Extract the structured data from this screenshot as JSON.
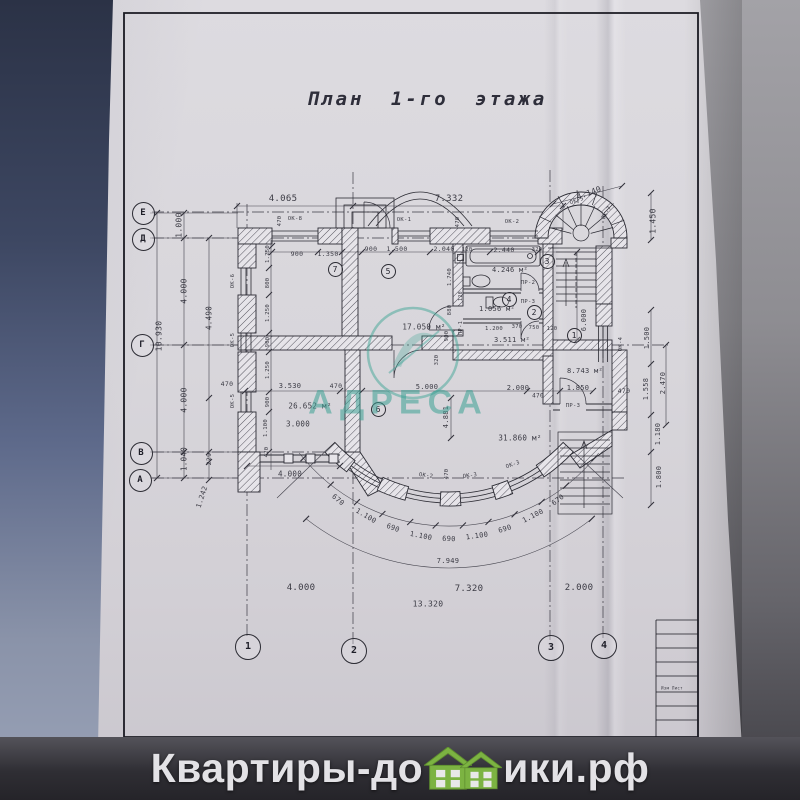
{
  "title": "План 1-го этажа",
  "watermark": {
    "logo_text": "АДРЕСА"
  },
  "brand": {
    "prefix": "Квартиры-до",
    "suffix": "ики.рф"
  },
  "colors": {
    "accent_teal": "#3fa593",
    "brand_green": "#7cb342",
    "paper": "#d8d6db",
    "ink": "#2b2b33"
  },
  "axes": {
    "left": [
      "Е",
      "Д",
      "Г",
      "В",
      "А"
    ],
    "bottom": [
      "1",
      "2",
      "3",
      "4"
    ]
  },
  "plan": {
    "axis_marks": [
      {
        "l": "Е",
        "x": 142,
        "y": 212,
        "d": 21
      },
      {
        "l": "Д",
        "x": 142,
        "y": 238,
        "d": 21
      },
      {
        "l": "Г",
        "x": 141,
        "y": 344,
        "d": 21
      },
      {
        "l": "В",
        "x": 140,
        "y": 452,
        "d": 21
      },
      {
        "l": "А",
        "x": 139,
        "y": 479,
        "d": 21
      },
      {
        "l": "1",
        "x": 247,
        "y": 646,
        "d": 24
      },
      {
        "l": "2",
        "x": 353,
        "y": 650,
        "d": 24
      },
      {
        "l": "3",
        "x": 550,
        "y": 647,
        "d": 24
      },
      {
        "l": "4",
        "x": 603,
        "y": 645,
        "d": 24
      }
    ],
    "rooms": [
      {
        "n": "7",
        "x": 334,
        "y": 268
      },
      {
        "n": "5",
        "x": 387,
        "y": 270
      },
      {
        "n": "3",
        "x": 546,
        "y": 260
      },
      {
        "n": "4",
        "x": 508,
        "y": 298
      },
      {
        "n": "2",
        "x": 533,
        "y": 311
      },
      {
        "n": "1",
        "x": 573,
        "y": 334
      },
      {
        "n": "6",
        "x": 377,
        "y": 408
      }
    ],
    "texts": [
      {
        "t": "4.065",
        "x": 283,
        "y": 199,
        "s": 9
      },
      {
        "t": "7.332",
        "x": 449,
        "y": 199,
        "s": 9
      },
      {
        "t": "4.140",
        "x": 589,
        "y": 193,
        "r": -20,
        "s": 8
      },
      {
        "t": "ОК-5",
        "x": 577,
        "y": 201,
        "r": -20,
        "s": 5.5,
        "n": "window-tag"
      },
      {
        "t": "ОК-7",
        "x": 607,
        "y": 213,
        "r": -60,
        "s": 5.5,
        "n": "window-tag"
      },
      {
        "t": "1.450",
        "x": 653,
        "y": 221,
        "r": -90,
        "s": 8
      },
      {
        "t": "ОК-8",
        "x": 295,
        "y": 219,
        "s": 5.5,
        "n": "window-tag"
      },
      {
        "t": "ОК-1",
        "x": 404,
        "y": 220,
        "s": 5.5,
        "n": "window-tag"
      },
      {
        "t": "ОК-2",
        "x": 512,
        "y": 222,
        "s": 5.5,
        "n": "window-tag"
      },
      {
        "t": "470",
        "x": 280,
        "y": 221,
        "r": -90,
        "s": 5.5
      },
      {
        "t": "470",
        "x": 458,
        "y": 222,
        "r": -90,
        "s": 5.5
      },
      {
        "t": "900",
        "x": 297,
        "y": 254,
        "s": 6.5
      },
      {
        "t": "1.350",
        "x": 328,
        "y": 254,
        "s": 6.5
      },
      {
        "t": "900",
        "x": 371,
        "y": 249,
        "s": 6.5
      },
      {
        "t": "1.500",
        "x": 397,
        "y": 249,
        "s": 6.5
      },
      {
        "t": "2.040",
        "x": 444,
        "y": 249,
        "s": 6.5
      },
      {
        "t": "120",
        "x": 467,
        "y": 250,
        "s": 5.5
      },
      {
        "t": "2.440",
        "x": 504,
        "y": 250,
        "s": 6.5
      },
      {
        "t": "320",
        "x": 537,
        "y": 250,
        "s": 5.5
      },
      {
        "t": "1.000",
        "x": 179,
        "y": 225,
        "r": -90,
        "s": 8
      },
      {
        "t": "4.000",
        "x": 184,
        "y": 291,
        "r": -90,
        "s": 8
      },
      {
        "t": "10.930",
        "x": 159,
        "y": 336,
        "r": -90,
        "s": 8
      },
      {
        "t": "4.490",
        "x": 209,
        "y": 318,
        "r": -90,
        "s": 7.5
      },
      {
        "t": "4.000",
        "x": 184,
        "y": 400,
        "r": -90,
        "s": 8
      },
      {
        "t": "1.040",
        "x": 184,
        "y": 459,
        "r": -90,
        "s": 7.5
      },
      {
        "t": "229",
        "x": 209,
        "y": 459,
        "r": -90,
        "s": 6.5
      },
      {
        "t": "1.242",
        "x": 202,
        "y": 497,
        "r": -72,
        "s": 7
      },
      {
        "t": "470",
        "x": 227,
        "y": 384,
        "s": 6.5
      },
      {
        "t": "ОК-6",
        "x": 233,
        "y": 281,
        "r": -90,
        "s": 5.5,
        "n": "window-tag"
      },
      {
        "t": "ОК-5",
        "x": 233,
        "y": 340,
        "r": -90,
        "s": 5.5,
        "n": "window-tag"
      },
      {
        "t": "ОК-5",
        "x": 233,
        "y": 401,
        "r": -90,
        "s": 5.5,
        "n": "window-tag"
      },
      {
        "t": "1.250",
        "x": 268,
        "y": 254,
        "r": -90,
        "s": 5.5
      },
      {
        "t": "800",
        "x": 268,
        "y": 283,
        "r": -90,
        "s": 5.5
      },
      {
        "t": "1.250",
        "x": 268,
        "y": 313,
        "r": -90,
        "s": 5.5
      },
      {
        "t": "900",
        "x": 268,
        "y": 342,
        "r": -90,
        "s": 5.5
      },
      {
        "t": "1.250",
        "x": 268,
        "y": 370,
        "r": -90,
        "s": 5.5
      },
      {
        "t": "900",
        "x": 268,
        "y": 402,
        "r": -90,
        "s": 5.5
      },
      {
        "t": "1.100",
        "x": 266,
        "y": 428,
        "r": -90,
        "s": 5.5
      },
      {
        "t": "470",
        "x": 267,
        "y": 452,
        "r": -90,
        "s": 5.5
      },
      {
        "t": "17.050 м²",
        "x": 424,
        "y": 327,
        "s": 7.5,
        "n": "room-area-label"
      },
      {
        "t": "4.246 м²",
        "x": 510,
        "y": 270,
        "s": 7,
        "n": "room-area-label"
      },
      {
        "t": "1.056 м²",
        "x": 497,
        "y": 309,
        "s": 7,
        "n": "room-area-label"
      },
      {
        "t": "3.511 м²",
        "x": 512,
        "y": 340,
        "s": 7,
        "n": "room-area-label"
      },
      {
        "t": "26.652 м²",
        "x": 310,
        "y": 406,
        "s": 7.5,
        "n": "room-area-label"
      },
      {
        "t": "31.860 м²",
        "x": 520,
        "y": 438,
        "s": 7.5,
        "n": "room-area-label"
      },
      {
        "t": "8.743 м²",
        "x": 585,
        "y": 371,
        "s": 7,
        "n": "room-area-label"
      },
      {
        "t": "3.000",
        "x": 298,
        "y": 424,
        "s": 7.5
      },
      {
        "t": "ПР-2",
        "x": 528,
        "y": 283,
        "s": 5.5,
        "n": "door-tag"
      },
      {
        "t": "ПР-3",
        "x": 528,
        "y": 302,
        "s": 5.5,
        "n": "door-tag"
      },
      {
        "t": "ПР-1",
        "x": 461,
        "y": 328,
        "r": -90,
        "s": 5.5,
        "n": "door-tag"
      },
      {
        "t": "ПР-3",
        "x": 573,
        "y": 406,
        "s": 5.5,
        "n": "door-tag"
      },
      {
        "t": "1.200",
        "x": 494,
        "y": 329,
        "s": 5.5
      },
      {
        "t": "370",
        "x": 517,
        "y": 327,
        "s": 5.5
      },
      {
        "t": "750",
        "x": 534,
        "y": 328,
        "s": 5.5
      },
      {
        "t": "120",
        "x": 552,
        "y": 329,
        "s": 5.5
      },
      {
        "t": "1.740",
        "x": 450,
        "y": 277,
        "r": -90,
        "s": 5.5
      },
      {
        "t": "120",
        "x": 461,
        "y": 296,
        "r": -90,
        "s": 5
      },
      {
        "t": "880",
        "x": 450,
        "y": 310,
        "r": -90,
        "s": 5.5
      },
      {
        "t": "900",
        "x": 447,
        "y": 336,
        "r": -90,
        "s": 5.5
      },
      {
        "t": "320",
        "x": 437,
        "y": 360,
        "r": -90,
        "s": 5.5
      },
      {
        "t": "6.000",
        "x": 584,
        "y": 320,
        "r": -90,
        "s": 7
      },
      {
        "t": "3.530",
        "x": 290,
        "y": 386,
        "s": 7
      },
      {
        "t": "470",
        "x": 336,
        "y": 386,
        "s": 6.5
      },
      {
        "t": "5.000",
        "x": 427,
        "y": 387,
        "s": 7
      },
      {
        "t": "2.000",
        "x": 518,
        "y": 388,
        "s": 7
      },
      {
        "t": "470",
        "x": 538,
        "y": 396,
        "s": 6
      },
      {
        "t": "1.850",
        "x": 578,
        "y": 388,
        "s": 7
      },
      {
        "t": "470",
        "x": 624,
        "y": 391,
        "s": 6.5
      },
      {
        "t": "4.881",
        "x": 446,
        "y": 417,
        "r": -90,
        "s": 7
      },
      {
        "t": "4.000",
        "x": 290,
        "y": 474,
        "s": 7.5
      },
      {
        "t": "ОК-4",
        "x": 621,
        "y": 344,
        "r": -90,
        "s": 5.5,
        "n": "window-tag"
      },
      {
        "t": "1.500",
        "x": 647,
        "y": 338,
        "r": -90,
        "s": 7
      },
      {
        "t": "1.558",
        "x": 646,
        "y": 389,
        "r": -90,
        "s": 7
      },
      {
        "t": "2.470",
        "x": 663,
        "y": 383,
        "r": -90,
        "s": 7
      },
      {
        "t": "1.180",
        "x": 658,
        "y": 434,
        "r": -90,
        "s": 7
      },
      {
        "t": "1.800",
        "x": 659,
        "y": 477,
        "r": -90,
        "s": 7
      },
      {
        "t": "ОК-2",
        "x": 426,
        "y": 476,
        "r": 8,
        "s": 5.5,
        "n": "window-tag"
      },
      {
        "t": "470",
        "x": 447,
        "y": 474,
        "r": -90,
        "s": 5.5
      },
      {
        "t": "ОК-3",
        "x": 470,
        "y": 476,
        "r": -8,
        "s": 5.5,
        "n": "window-tag"
      },
      {
        "t": "ОК-3",
        "x": 513,
        "y": 465,
        "r": -20,
        "s": 5.5,
        "n": "window-tag"
      },
      {
        "t": "670",
        "x": 338,
        "y": 500,
        "r": 40,
        "s": 7
      },
      {
        "t": "1.100",
        "x": 366,
        "y": 516,
        "r": 31,
        "s": 7
      },
      {
        "t": "690",
        "x": 393,
        "y": 528,
        "r": 21,
        "s": 7
      },
      {
        "t": "1.100",
        "x": 421,
        "y": 536,
        "r": 11,
        "s": 7
      },
      {
        "t": "690",
        "x": 449,
        "y": 539,
        "r": 2,
        "s": 7
      },
      {
        "t": "1.100",
        "x": 477,
        "y": 536,
        "r": -8,
        "s": 7
      },
      {
        "t": "690",
        "x": 505,
        "y": 529,
        "r": -17,
        "s": 7
      },
      {
        "t": "1.100",
        "x": 533,
        "y": 516,
        "r": -27,
        "s": 7
      },
      {
        "t": "670",
        "x": 558,
        "y": 500,
        "r": -38,
        "s": 7
      },
      {
        "t": "7.949",
        "x": 448,
        "y": 561,
        "s": 7
      },
      {
        "t": "4.000",
        "x": 301,
        "y": 588,
        "s": 9
      },
      {
        "t": "7.320",
        "x": 469,
        "y": 589,
        "s": 9
      },
      {
        "t": "2.000",
        "x": 579,
        "y": 588,
        "s": 9
      },
      {
        "t": "13.320",
        "x": 428,
        "y": 604,
        "s": 8
      },
      {
        "t": "Изм  Лист",
        "x": 672,
        "y": 688,
        "s": 4,
        "n": "titleblock-text"
      }
    ]
  }
}
